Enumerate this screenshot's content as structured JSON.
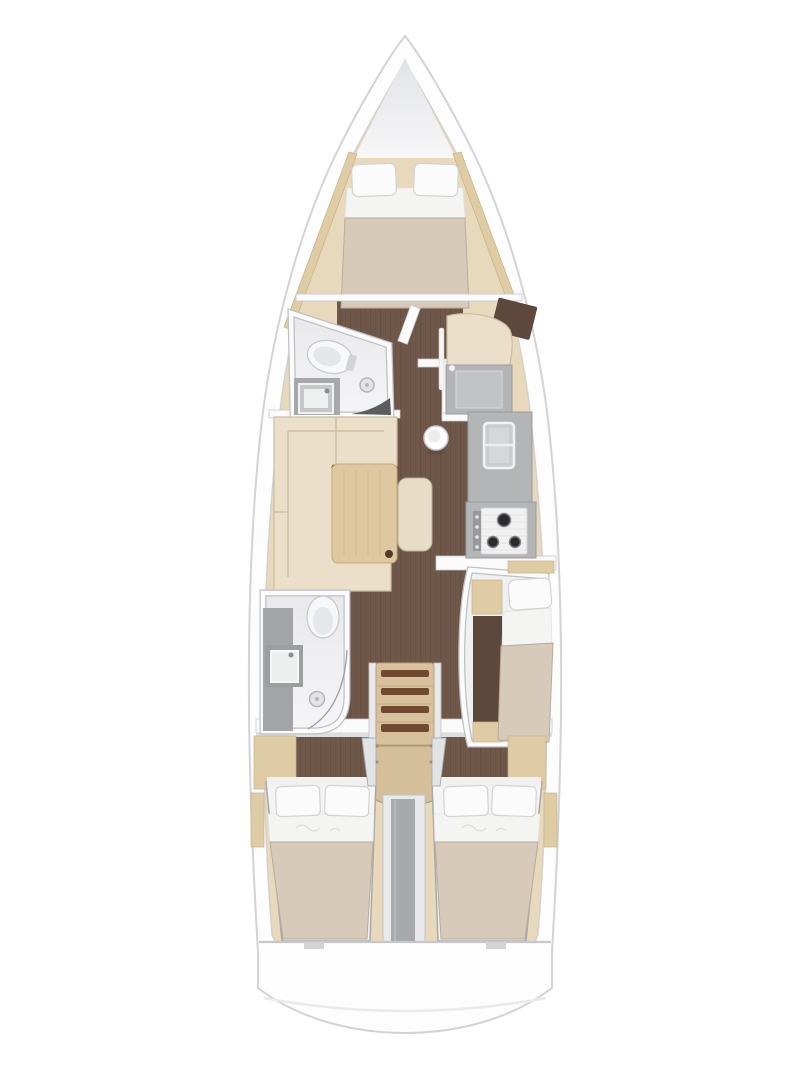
{
  "meta": {
    "type": "yacht-interior-floor-plan",
    "orientation": "bow-up",
    "cabins": 3,
    "heads": 2,
    "berths": [
      "v-berth-double",
      "single-berth",
      "double-berth",
      "double-berth"
    ]
  },
  "areas": [
    "bow-anchor-locker",
    "forward-cabin",
    "forward-head",
    "nav-station",
    "saloon",
    "galley",
    "aft-head",
    "mid-single-cabin",
    "companionway",
    "port-aft-cabin",
    "starboard-aft-cabin",
    "engine-compartment",
    "stern-deck"
  ],
  "fixtures": [
    "toilet",
    "washbasin",
    "shower-drain",
    "chart-table-seat",
    "saloon-sofa",
    "saloon-table",
    "side-table",
    "top-loading-fridge",
    "galley-sink",
    "three-burner-stove",
    "companionway-steps",
    "wardrobe",
    "compression-post"
  ],
  "palette": {
    "hull": "#fdfdfe",
    "hull_line": "#d2d3d6",
    "int_edge": "#c7c8cb",
    "wood": "#e8d9bd",
    "wood_trim": "#dfcba4",
    "floor": "#6f574a",
    "plank_line": "#3c2817",
    "wall": "#fbfbfc",
    "wall_line": "#c9cacd",
    "room_line": "#bfc0c3",
    "counter": "#b4b5b6",
    "counter_line": "#9a9b9d",
    "fixture": "#f4f5f6",
    "bath_top": "#e9e9ec",
    "bath_bottom": "#f5f5f7",
    "mattress": "#d7cab8",
    "mattress_line": "#b6ab9d",
    "sheet": "#f4f4f3",
    "pillow": "#fbfbfc",
    "pillow_line": "#d2d2d4",
    "sofa": "#ecdfc9",
    "sofa_line": "#cdbda0",
    "seam": "#c8b799",
    "oak": "#dfc7a0",
    "oak_line": "#c4a97b",
    "steps": "#d8c29e",
    "tread": "#6f4a2f",
    "divider": "#a8a9ab",
    "walnut_dark": "#5e483c",
    "anchor_top": "#e2e3e6",
    "anchor_bottom": "#f7f7f8",
    "stern_line": "#c6c7c9",
    "transom_line": "#e9eaec"
  }
}
